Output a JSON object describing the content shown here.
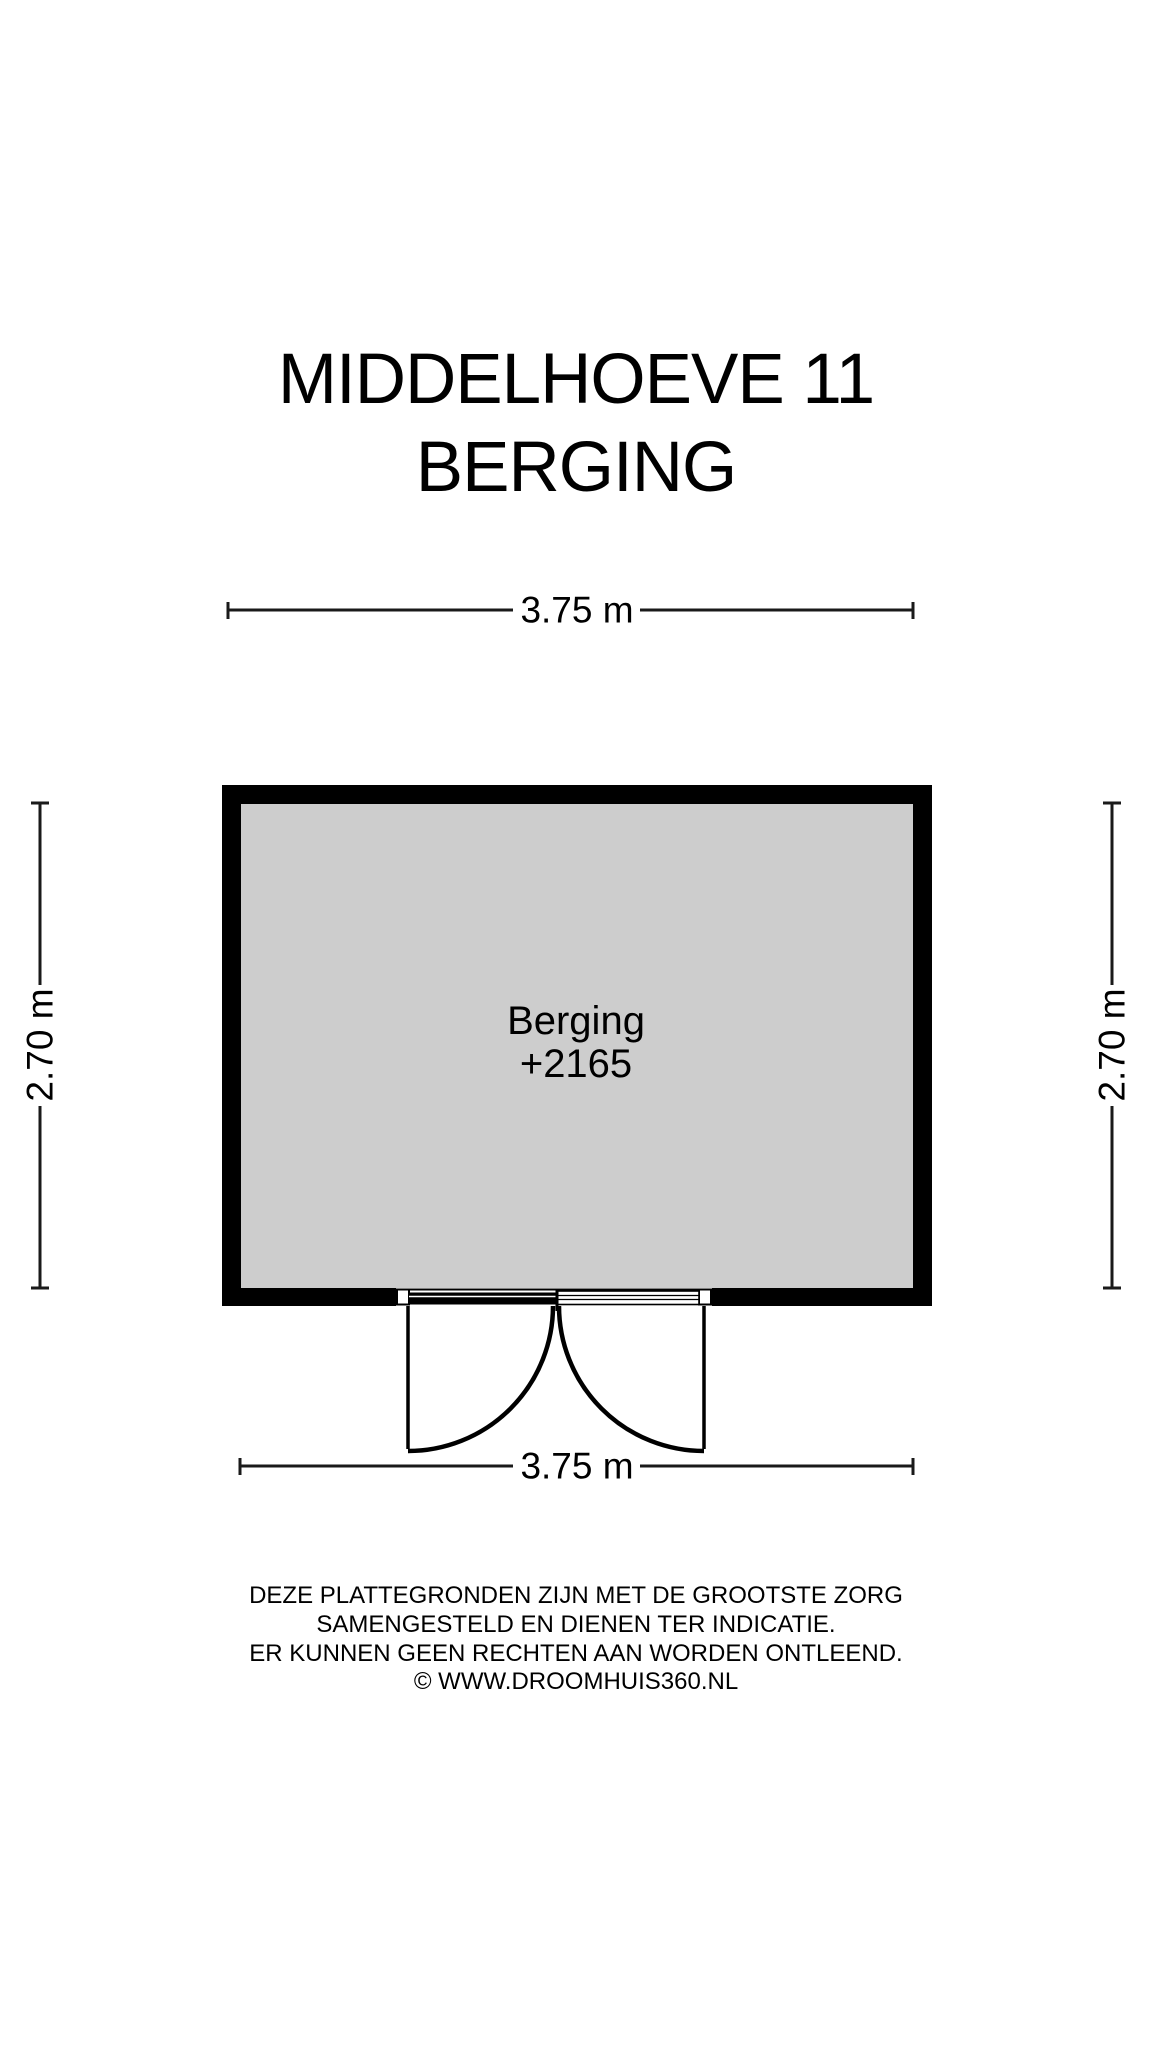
{
  "title": {
    "line1": "MIDDELHOEVE 11",
    "line2": "BERGING"
  },
  "room": {
    "name": "Berging",
    "elevation": "+2165"
  },
  "dimensions": {
    "width_top": "3.75 m",
    "width_bottom": "3.75 m",
    "height_left": "2.70 m",
    "height_right": "2.70 m"
  },
  "disclaimer": {
    "line1": "DEZE PLATTEGRONDEN ZIJN MET DE GROOTSTE ZORG",
    "line2": "SAMENGESTELD EN DIENEN TER INDICATIE.",
    "line3": "ER KUNNEN GEEN RECHTEN AAN WORDEN ONTLEEND.",
    "line4": "© WWW.DROOMHUIS360.NL"
  },
  "colors": {
    "wall": "#000000",
    "room_fill": "#cdcdcd",
    "background": "#ffffff",
    "text": "#000000"
  }
}
